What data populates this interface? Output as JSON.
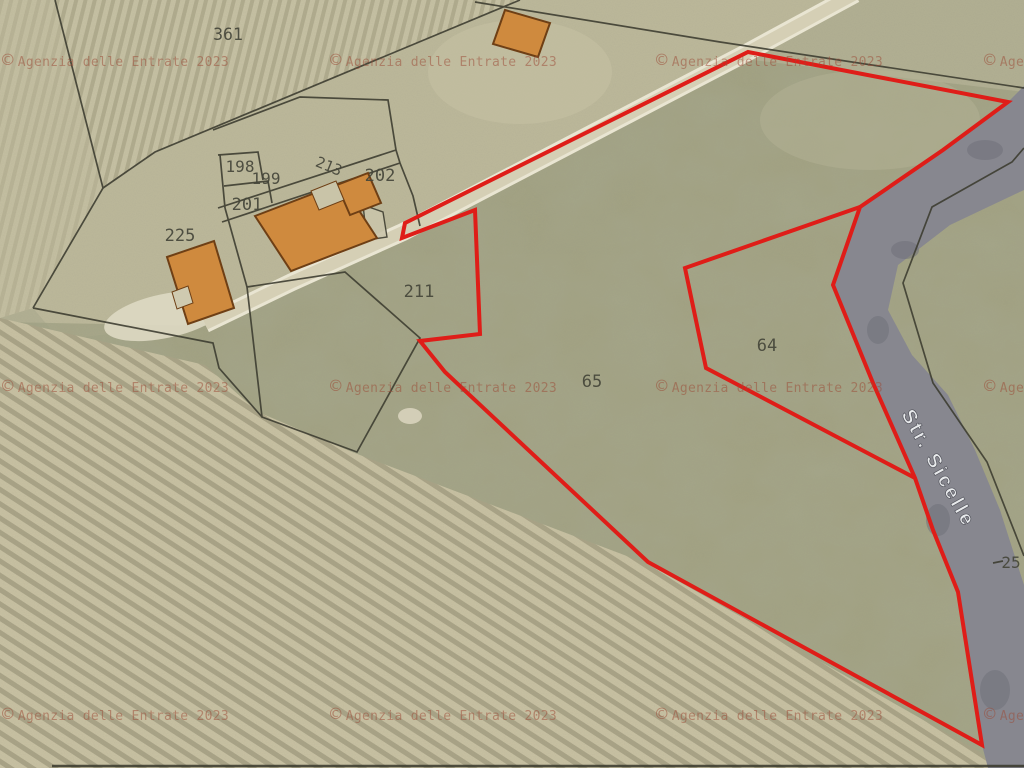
{
  "map": {
    "title": "Cadastral aerial map extract",
    "watermark_symbol": "©",
    "watermark_text": "Agenzia delle Entrate 2023",
    "street_label": "Str. Sicelle",
    "parcels": [
      {
        "id": "361",
        "x": 228,
        "y": 40,
        "size": 16.5,
        "rot": 0
      },
      {
        "id": "198",
        "x": 240,
        "y": 172,
        "size": 16,
        "rot": 0
      },
      {
        "id": "199",
        "x": 266,
        "y": 184,
        "size": 16,
        "rot": 0
      },
      {
        "id": "201",
        "x": 247,
        "y": 210,
        "size": 17,
        "rot": 0
      },
      {
        "id": "213",
        "x": 327,
        "y": 171,
        "size": 15,
        "rot": 22
      },
      {
        "id": "202",
        "x": 380,
        "y": 181,
        "size": 17,
        "rot": 0
      },
      {
        "id": "225",
        "x": 180,
        "y": 241,
        "size": 17,
        "rot": 0
      },
      {
        "id": "211",
        "x": 419,
        "y": 297,
        "size": 17,
        "rot": 0
      },
      {
        "id": "65",
        "x": 592,
        "y": 387,
        "size": 17,
        "rot": 0
      },
      {
        "id": "64",
        "x": 767,
        "y": 351,
        "size": 17,
        "rot": 0
      },
      {
        "id": "25",
        "x": 1011,
        "y": 568,
        "size": 16,
        "rot": 0
      }
    ],
    "colors": {
      "boundary_red": "#df1d18",
      "building_fill": "#cf8a3e",
      "building_stroke": "#6e3f15",
      "road_gray": "#87878f",
      "watermark": "#9c4a36",
      "parcel_label": "#45463a",
      "black_boundary": "#3b3b2f"
    }
  }
}
